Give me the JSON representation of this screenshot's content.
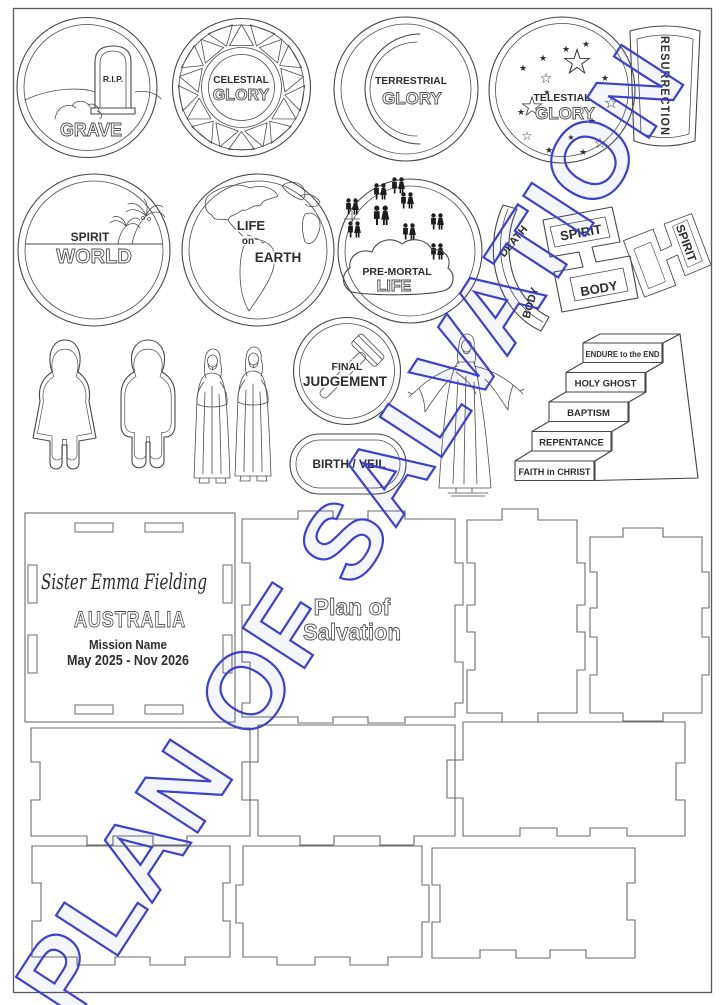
{
  "watermark": {
    "text": "PLAN OF SALVATION",
    "color": "#3c43c9"
  },
  "pieces": {
    "grave": {
      "rip": "R.I.P.",
      "label": "GRAVE"
    },
    "celestial": {
      "top": "CELESTIAL",
      "bottom": "GLORY"
    },
    "terrestrial": {
      "top": "TERRESTRIAL",
      "bottom": "GLORY"
    },
    "telestial": {
      "top": "TELESTIAL",
      "bottom": "GLORY"
    },
    "resurrection": {
      "label": "RESURRECTION"
    },
    "spirit_world": {
      "top": "SPIRIT",
      "bottom": "WORLD"
    },
    "life_on_earth": {
      "line1": "LIFE",
      "line2": "on",
      "line3": "EARTH"
    },
    "premortal": {
      "top": "PRE-MORTAL",
      "bottom": "LIFE"
    },
    "death": {
      "label": "DEATH",
      "body": "BODY"
    },
    "spirit_body": {
      "spirit": "SPIRIT",
      "body": "BODY"
    },
    "spirit_body_right": {
      "spirit": "SPIRIT"
    },
    "final_judgement": {
      "top": "FINAL",
      "bottom": "JUDGEMENT"
    },
    "birth_veil": {
      "label": "BIRTH / VEIL"
    }
  },
  "stairs": {
    "steps": [
      "ENDURE to the END",
      "HOLY GHOST",
      "BAPTISM",
      "REPENTANCE",
      "FAITH in CHRIST"
    ]
  },
  "name_panel": {
    "name": "Sister Emma Fielding",
    "country": "AUSTRALIA",
    "mission_line": "Mission Name",
    "dates": "May 2025 - Nov 2026"
  },
  "title_panel": {
    "line1": "Plan of",
    "line2": "Salvation"
  },
  "icons": {
    "star_filled": "★",
    "star_outline": "☆"
  },
  "colors": {
    "watermark_blue": "#3c43c9",
    "line_dark": "#474747",
    "line_light": "#6b6b6b"
  }
}
